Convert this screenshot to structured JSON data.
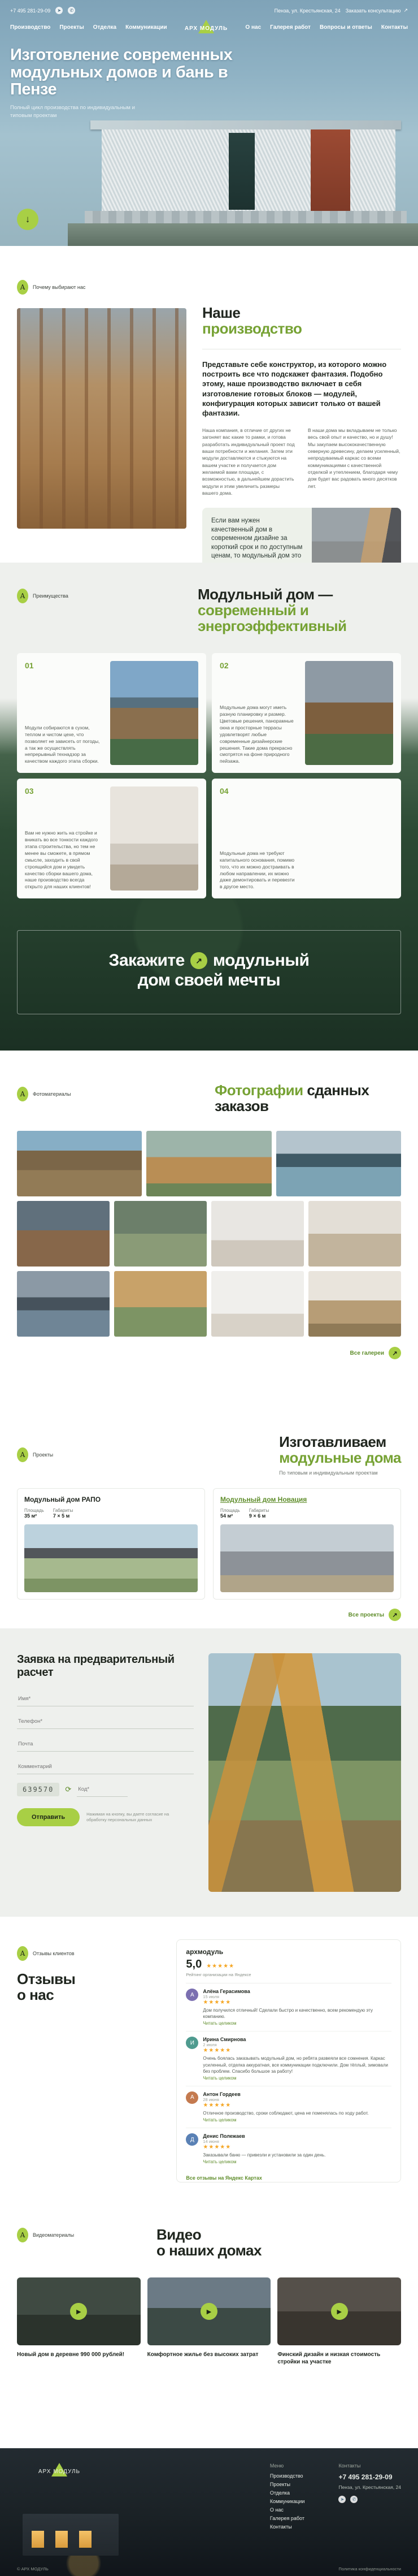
{
  "accent": {
    "green_text": "#76a234",
    "lime": "#a8cf45",
    "stars_color": "#f5a623"
  },
  "header": {
    "phone": "+7 495 281-29-09",
    "address": "Пенза, ул. Крестьянская, 24",
    "cta": "Заказать консультацию",
    "cta_arrow": "↗",
    "logo": "АРХ МОДУЛЬ",
    "nav_left": [
      "Производство",
      "Проекты",
      "Отделка",
      "Коммуникации"
    ],
    "nav_right": [
      "О нас",
      "Галерея работ",
      "Вопросы и ответы",
      "Контакты"
    ]
  },
  "hero": {
    "title": "Изготовление современных модульных домов и бань в Пензе",
    "subtitle": "Полный цикл производства по индивидуальным и типовым проектам",
    "scroll_arrow": "↓"
  },
  "production": {
    "label": "Почему выбирают нас",
    "heading1": "Наше",
    "heading2": "производство",
    "lead": "Представьте себе конструктор, из которого можно построить все что подскажет фантазия. Подобно этому, наше производство включает в себя изготовление готовых блоков — модулей, конфигурация которых зависит только от вашей фантазии.",
    "col1": "Наша компания, в отличие от других не загоняет вас какие то рамки, и готова разработать индивидуальный проект под ваши потребности и желания. Затем эти модули доставляются и стыкуются на вашем участке и получается дом желаемой вами площади, с возможностью, в дальнейшем дорастить модули и этим увеличить размеры вашего дома.",
    "col2": "В наши дома мы вкладываем не только весь свой опыт и качество, но и душу! Мы закупаем высококачественную северную древесину, делаем усиленный, непродуваемый каркас со всеми коммуникациями с качественной отделкой и утеплением, благодаря чему дом будет вас радовать много десятков лет.",
    "card_text": "Если вам нужен качественный дом в современном дизайне за короткий срок и по доступным ценам, то модульный дом это то, что вам нужно.",
    "card_link": "Подробнее о производстве",
    "card_link_arrow": "↗"
  },
  "advantages": {
    "label": "Преимущества",
    "heading1": "Модульный дом —",
    "heading2": "современный и энергоэффективный",
    "cards": [
      {
        "num": "01",
        "text": "Модули собираются в сухом, теплом и чистом цехе, что позволяет не зависеть от погоды, а так же осуществлять непрерывный технадзор за качеством каждого этапа сборки."
      },
      {
        "num": "02",
        "text": "Модульные дома могут иметь разную планировку и размер. Цветовые решения, панорамные окна и просторные террасы удовлетворят любые современные дизайнерские решения. Такие дома прекрасно смотрятся на фоне природного пейзажа."
      },
      {
        "num": "03",
        "text": "Вам не нужно жить на стройке и вникать во все тонкости каждого этапа строительства, но тем не менее вы сможете, в прямом смысле, заходить в свой строящийся дом и увидеть качество сборки вашего дома, наше производство всегда открыто для наших клиентов!"
      },
      {
        "num": "04",
        "text": "Модульные дома не требуют капитального основания, помимо того, что их можно достраивать в любом направлении, их можно даже демонтировать и перевезти в другое место."
      }
    ]
  },
  "banner": {
    "word1": "Закажите",
    "arrow": "↗",
    "word2": "модульный",
    "line2": "дом своей мечты"
  },
  "gallery": {
    "label": "Фотоматериалы",
    "heading_green": "Фотографии",
    "heading_rest": "сданных заказов",
    "link": "Все галереи",
    "link_arrow": "↗"
  },
  "projects": {
    "label": "Проекты",
    "heading1": "Изготавливаем",
    "heading2": "модульные дома",
    "subtitle": "По типовым и индивидуальным проектам",
    "cards": [
      {
        "title": "Модульный дом РАПО",
        "specs": [
          {
            "label": "Площадь",
            "value": "35 м²"
          },
          {
            "label": "Габариты",
            "value": "7 × 5 м"
          }
        ]
      },
      {
        "title": "Модульный дом Новация",
        "specs": [
          {
            "label": "Площадь",
            "value": "54 м²"
          },
          {
            "label": "Габариты",
            "value": "9 × 6 м"
          }
        ]
      }
    ],
    "link": "Все проекты",
    "link_arrow": "↗"
  },
  "request_form": {
    "heading": "Заявка на предварительный расчет",
    "fields": [
      {
        "placeholder": "Имя*"
      },
      {
        "placeholder": "Телефон*"
      },
      {
        "placeholder": "Почта"
      },
      {
        "placeholder": "Комментарий"
      }
    ],
    "captcha": {
      "code": "639570",
      "refresh": "⟳",
      "placeholder": "Код*"
    },
    "submit": "Отправить",
    "consent": "Нажимая на кнопку, вы даете согласие на обработку персональных данных"
  },
  "reviews": {
    "label": "Отзывы клиентов",
    "heading1": "Отзывы",
    "heading2": "о нас",
    "widget": {
      "org": "архмодуль",
      "score": "5,0",
      "stars": "★★★★★",
      "caption": "Рейтинг организации на Яндексе"
    },
    "items": [
      {
        "initial": "А",
        "name": "Алёна Герасимова",
        "date": "15 июля",
        "stars": "★★★★★",
        "text": "Дом получился отличный! Сделали быстро и качественно, всем рекомендую эту компанию.",
        "more": "Читать целиком"
      },
      {
        "initial": "И",
        "name": "Ирина Смирнова",
        "date": "2 июля",
        "stars": "★★★★★",
        "text": "Очень боялась заказывать модульный дом, но ребята развеяли все сомнения. Каркас усиленный, отделка аккуратная, все коммуникации подключили. Дом тёплый, зимовали без проблем. Спасибо большое за работу!",
        "more": "Читать целиком"
      },
      {
        "initial": "А",
        "name": "Антон Гордеев",
        "date": "28 июня",
        "stars": "★★★★★",
        "text": "Отличное производство, сроки соблюдают, цена не поменялась по ходу работ.",
        "more": "Читать целиком"
      },
      {
        "initial": "Д",
        "name": "Денис Полежаев",
        "date": "14 июня",
        "stars": "★★★★★",
        "text": "Заказывали баню — привезли и установили за один день.",
        "more": "Читать целиком"
      }
    ],
    "all_link": "Все отзывы на Яндекс Картах"
  },
  "videos": {
    "label": "Видеоматериалы",
    "heading1": "Видео",
    "heading2": "о наших домах",
    "play": "▶",
    "items": [
      {
        "title": "Новый дом в деревне 990 000 рублей!"
      },
      {
        "title": "Комфортное жилье без высоких затрат"
      },
      {
        "title": "Финский дизайн и низкая стоимость стройки на участке"
      }
    ]
  },
  "footer": {
    "logo": "АРХ МОДУЛЬ",
    "menu_title": "Меню",
    "menu": [
      "Производство",
      "Проекты",
      "Отделка",
      "Коммуникации",
      "О нас",
      "Галерея работ",
      "Контакты"
    ],
    "contacts_title": "Контакты",
    "phone": "+7 495 281-29-09",
    "address": "Пенза, ул. Крестьянская, 24",
    "copyright": "© АРХ МОДУЛЬ",
    "privacy": "Политика конфиденциальности"
  },
  "icons": {
    "telegram": "➤",
    "whatsapp": "✆"
  }
}
